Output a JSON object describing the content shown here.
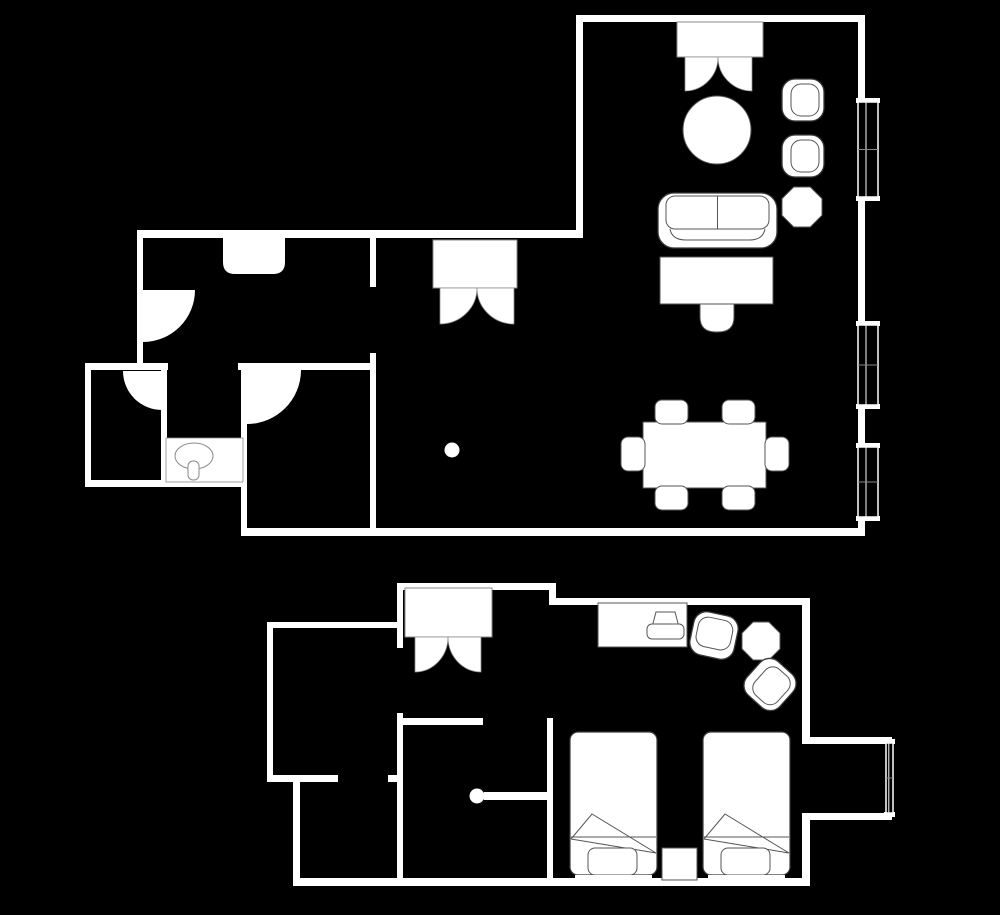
{
  "canvas": {
    "w": 1000,
    "h": 915,
    "bg": "#000000",
    "wall": "#ffffff",
    "fill": "#ffffff",
    "stroke_dark": "#3a3a3a",
    "stroke_mid": "#555555",
    "stroke_light": "#8a8a8a"
  },
  "plans": [
    {
      "name": "upper-floor-plan",
      "walls": [
        [
          137,
          230,
          446,
          8
        ],
        [
          576,
          15,
          7,
          223
        ],
        [
          576,
          15,
          289,
          7
        ],
        [
          858,
          15,
          7,
          87
        ],
        [
          858,
          197,
          7,
          128
        ],
        [
          858,
          405,
          7,
          42
        ],
        [
          858,
          517,
          7,
          14
        ],
        [
          241,
          528,
          624,
          8
        ],
        [
          241,
          365,
          6,
          163
        ],
        [
          85,
          365,
          6,
          122
        ],
        [
          85,
          480,
          162,
          7
        ],
        [
          85,
          363,
          83,
          7
        ],
        [
          238,
          363,
          134,
          7
        ],
        [
          137,
          230,
          6,
          140
        ],
        [
          161,
          363,
          6,
          118
        ],
        [
          370,
          237,
          6,
          50
        ],
        [
          370,
          353,
          6,
          175
        ]
      ],
      "doors": [
        {
          "name": "door-swing-bedroom-entry",
          "cx": 143,
          "cy": 290,
          "r": 52,
          "quad": "se"
        },
        {
          "name": "door-swing-wc",
          "cx": 162,
          "cy": 371,
          "r": 39,
          "quad": "sw"
        },
        {
          "name": "door-swing-bathroom",
          "cx": 247,
          "cy": 370,
          "r": 54,
          "quad": "se"
        }
      ],
      "french_doors": [
        {
          "name": "double-door-living-entry",
          "tx": 677,
          "ty": 22,
          "tw": 86,
          "th": 35,
          "ly": 57,
          "lh": 34,
          "left": 685,
          "mid": 718,
          "right": 752
        },
        {
          "name": "double-door-hall",
          "tx": 433,
          "ty": 240,
          "tw": 84,
          "th": 48,
          "ly": 288,
          "lh": 36,
          "left": 440,
          "mid": 477,
          "right": 514
        }
      ],
      "windows": [
        {
          "name": "window-1",
          "x": 858,
          "w": 20,
          "y1": 102,
          "y2": 197
        },
        {
          "name": "window-2",
          "x": 858,
          "w": 20,
          "y1": 325,
          "y2": 405
        },
        {
          "name": "window-3",
          "x": 858,
          "w": 20,
          "y1": 447,
          "y2": 517
        }
      ],
      "furniture": [
        {
          "type": "closet",
          "name": "wardrobe",
          "x": 223,
          "y": 238,
          "w": 62,
          "h": 36
        },
        {
          "type": "vanity",
          "name": "sink-vanity",
          "x": 166,
          "y": 438,
          "w": 77,
          "h": 44,
          "basin": {
            "cx": 194,
            "cy": 456,
            "rx": 19,
            "ry": 13
          },
          "faucet": {
            "x": 188,
            "y": 461,
            "w": 11,
            "h": 19
          }
        },
        {
          "type": "dot",
          "name": "column-dot",
          "cx": 452,
          "cy": 450,
          "r": 7.5
        },
        {
          "type": "circle",
          "name": "round-table",
          "cx": 717,
          "cy": 130,
          "r": 34
        },
        {
          "type": "armchair",
          "name": "armchair-1",
          "x": 782,
          "y": 79,
          "w": 42,
          "h": 42,
          "angle": 0
        },
        {
          "type": "armchair",
          "name": "armchair-2",
          "x": 782,
          "y": 135,
          "w": 42,
          "h": 42,
          "angle": 0
        },
        {
          "type": "octagon",
          "name": "side-table-octagon",
          "cx": 802,
          "cy": 207,
          "r": 20
        },
        {
          "type": "sofa",
          "name": "sofa",
          "x": 658,
          "y": 193,
          "w": 119,
          "h": 55
        },
        {
          "type": "rect",
          "name": "console-desk",
          "x": 660,
          "y": 257,
          "w": 113,
          "h": 47
        },
        {
          "type": "chair-tucked",
          "name": "desk-chair",
          "x": 700,
          "y": 304,
          "w": 34,
          "h": 28
        },
        {
          "type": "rect",
          "name": "dining-table",
          "x": 643,
          "y": 422,
          "w": 123,
          "h": 66
        },
        {
          "type": "chair",
          "name": "dining-chair-1",
          "x": 655,
          "y": 400,
          "w": 33,
          "h": 24
        },
        {
          "type": "chair",
          "name": "dining-chair-2",
          "x": 722,
          "y": 400,
          "w": 33,
          "h": 24
        },
        {
          "type": "chair",
          "name": "dining-chair-3",
          "x": 655,
          "y": 486,
          "w": 33,
          "h": 24
        },
        {
          "type": "chair",
          "name": "dining-chair-4",
          "x": 722,
          "y": 486,
          "w": 33,
          "h": 24
        },
        {
          "type": "chair",
          "name": "dining-chair-5",
          "x": 621,
          "y": 437,
          "w": 24,
          "h": 34
        },
        {
          "type": "chair",
          "name": "dining-chair-6",
          "x": 765,
          "y": 437,
          "w": 24,
          "h": 34
        }
      ]
    },
    {
      "name": "lower-floor-plan",
      "walls": [
        [
          397,
          583,
          159,
          7
        ],
        [
          549,
          583,
          7,
          22
        ],
        [
          549,
          598,
          261,
          7
        ],
        [
          802,
          598,
          8,
          139
        ],
        [
          802,
          737,
          90,
          7
        ],
        [
          802,
          813,
          90,
          7
        ],
        [
          802,
          820,
          8,
          62
        ],
        [
          293,
          878,
          517,
          8
        ],
        [
          293,
          782,
          7,
          96
        ],
        [
          267,
          775,
          71,
          7
        ],
        [
          388,
          775,
          9,
          7
        ],
        [
          267,
          622,
          6,
          160
        ],
        [
          267,
          622,
          136,
          6
        ],
        [
          397,
          583,
          6,
          65
        ],
        [
          397,
          713,
          6,
          169
        ],
        [
          397,
          718,
          86,
          7
        ],
        [
          547,
          718,
          6,
          164
        ]
      ],
      "doors": [],
      "french_doors": [
        {
          "name": "double-door-foyer",
          "tx": 405,
          "ty": 588,
          "tw": 87,
          "th": 49,
          "ly": 637,
          "lh": 35,
          "left": 415,
          "mid": 448,
          "right": 481
        }
      ],
      "windows": [
        {
          "name": "bay-window",
          "x": 886,
          "w": 7,
          "y1": 743,
          "y2": 813
        }
      ],
      "furniture": [
        {
          "type": "rect",
          "name": "desk",
          "x": 598,
          "y": 603,
          "w": 89,
          "h": 44
        },
        {
          "type": "chair-symbol",
          "name": "desk-chair-symbol",
          "x": 647,
          "y": 611,
          "w": 37,
          "h": 28
        },
        {
          "type": "armchair",
          "name": "armchair-1",
          "x": 692,
          "y": 613,
          "w": 44,
          "h": 45,
          "angle": -78
        },
        {
          "type": "octagon",
          "name": "side-table-octagon",
          "cx": 761,
          "cy": 641,
          "r": 19
        },
        {
          "type": "armchair",
          "name": "armchair-2",
          "x": 748,
          "y": 662,
          "w": 44,
          "h": 45,
          "angle": 42
        },
        {
          "type": "door-leaf",
          "name": "door-leaf",
          "x": 484,
          "y": 792,
          "w": 65,
          "h": 8
        },
        {
          "type": "dot",
          "name": "door-knob",
          "cx": 477,
          "cy": 796,
          "r": 7.5
        },
        {
          "type": "bed",
          "name": "bed-1",
          "x": 570,
          "y": 732,
          "w": 87,
          "h": 143
        },
        {
          "type": "bed",
          "name": "bed-2",
          "x": 703,
          "y": 732,
          "w": 87,
          "h": 143
        },
        {
          "type": "rect",
          "name": "nightstand",
          "x": 662,
          "y": 848,
          "w": 35,
          "h": 32
        }
      ]
    }
  ]
}
